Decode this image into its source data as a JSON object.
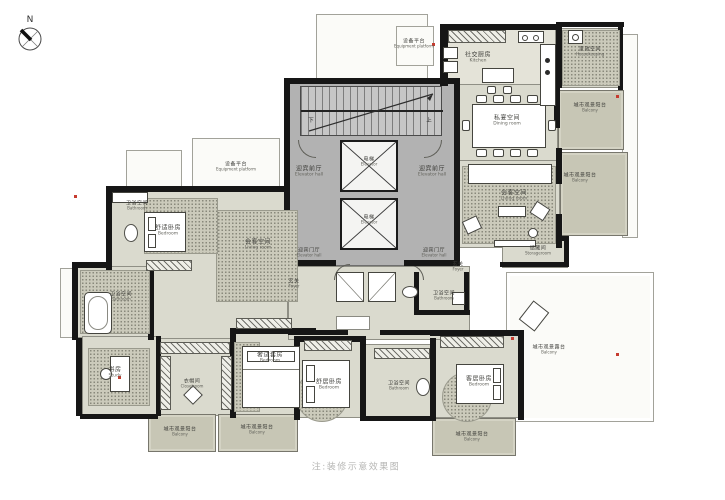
{
  "compass": {
    "label": "N"
  },
  "caption": "注:装修示意效果图",
  "stairs": {
    "up": "上",
    "down": "下"
  },
  "colors": {
    "wall": "#161616",
    "core": "#b2b2b2",
    "room": "#dadace",
    "balcony": "#c7c6b5",
    "accent_red": "#c63b2f",
    "caption_gray": "#b7b7b5"
  },
  "rooms": {
    "equipment_platform_left": {
      "zh": "设备平台",
      "en": "Equipment platform"
    },
    "equipment_platform_top": {
      "zh": "设备平台",
      "en": "Equipment platform"
    },
    "kitchen": {
      "zh": "社交厨房",
      "en": "Kitchen"
    },
    "housekeeping": {
      "zh": "家政空间",
      "en": "Housekeeping"
    },
    "balcony_tr1": {
      "zh": "城市观景阳台",
      "en": "Balcony"
    },
    "dining_room": {
      "zh": "私宴空间",
      "en": "Dining room"
    },
    "living_room_right": {
      "zh": "会客空间",
      "en": "Living room"
    },
    "balcony_tr2": {
      "zh": "城市观景阳台",
      "en": "Balcony"
    },
    "storage_room": {
      "zh": "储藏间",
      "en": "Storageroom"
    },
    "elevator_hall_left": {
      "zh": "迎宾前厅",
      "en": "Elevator hall"
    },
    "elevator_hall_right": {
      "zh": "迎宾前厅",
      "en": "Elevator hall"
    },
    "elevator_1": {
      "zh": "电梯",
      "en": "Elevator"
    },
    "elevator_2": {
      "zh": "电梯",
      "en": "Elevator"
    },
    "reception_hall_left": {
      "zh": "迎宾门厅",
      "en": "Elevator hall"
    },
    "reception_hall_right": {
      "zh": "迎宾门厅",
      "en": "Elevator hall"
    },
    "foyer_left": {
      "zh": "玄关",
      "en": "Foyer"
    },
    "foyer_right": {
      "zh": "玄关",
      "en": "Foyer"
    },
    "bathroom_core_right": {
      "zh": "卫浴空间",
      "en": "Bathroom"
    },
    "bathroom_top_left": {
      "zh": "卫浴空间",
      "en": "Bathroom"
    },
    "bedroom_top_left": {
      "zh": "舒适卧房",
      "en": "Bedroom"
    },
    "family_room_left": {
      "zh": "会客空间",
      "en": "Living room"
    },
    "bathroom_left": {
      "zh": "卫浴空间",
      "en": "Bathroom"
    },
    "study": {
      "zh": "书房",
      "en": "Study"
    },
    "closet_room": {
      "zh": "衣帽间",
      "en": "Closetroom"
    },
    "bedroom_master": {
      "zh": "奢适套房",
      "en": "Bedroom"
    },
    "bedroom_mid": {
      "zh": "舒居卧房",
      "en": "Bedroom"
    },
    "bathroom_bottom": {
      "zh": "卫浴空间",
      "en": "Bathroom"
    },
    "bedroom_right": {
      "zh": "客居卧房",
      "en": "Bedroom"
    },
    "balcony_bl1": {
      "zh": "城市观景阳台",
      "en": "Balcony"
    },
    "balcony_bl2": {
      "zh": "城市观景阳台",
      "en": "Balcony"
    },
    "balcony_br": {
      "zh": "城市观景阳台",
      "en": "Balcony"
    },
    "terrace": {
      "zh": "城市观景露台",
      "en": "Balcony"
    }
  }
}
